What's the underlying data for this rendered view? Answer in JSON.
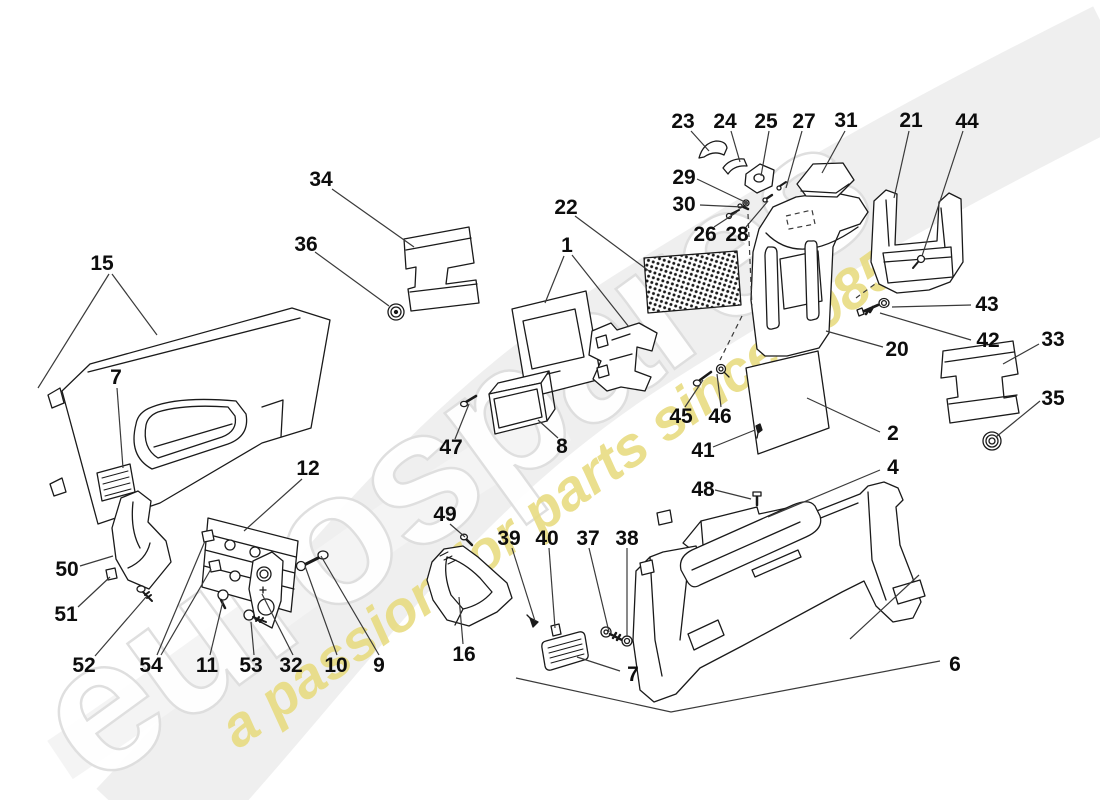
{
  "canvas": {
    "width": 1100,
    "height": 800
  },
  "watermark": {
    "brand_word": "eurospares",
    "tagline": "a passion for parts since 1985",
    "word_fill": "#ffffff",
    "word_outline": "#dedede",
    "tagline_color": "#e8dc82",
    "swoosh_color": "#efefef"
  },
  "colors": {
    "part_line": "#1a1a1a",
    "leader_line": "#3a3a3a",
    "mesh_dot": "#1a1a1a"
  },
  "diagram": {
    "labels": [
      {
        "n": "23",
        "x": 683,
        "y": 122
      },
      {
        "n": "24",
        "x": 725,
        "y": 122
      },
      {
        "n": "25",
        "x": 766,
        "y": 122
      },
      {
        "n": "27",
        "x": 804,
        "y": 122
      },
      {
        "n": "31",
        "x": 846,
        "y": 121
      },
      {
        "n": "21",
        "x": 911,
        "y": 121
      },
      {
        "n": "44",
        "x": 967,
        "y": 122
      },
      {
        "n": "29",
        "x": 684,
        "y": 178
      },
      {
        "n": "30",
        "x": 684,
        "y": 205
      },
      {
        "n": "26",
        "x": 705,
        "y": 235
      },
      {
        "n": "28",
        "x": 737,
        "y": 235
      },
      {
        "n": "22",
        "x": 566,
        "y": 208
      },
      {
        "n": "1",
        "x": 567,
        "y": 246
      },
      {
        "n": "34",
        "x": 321,
        "y": 180
      },
      {
        "n": "36",
        "x": 306,
        "y": 245
      },
      {
        "n": "15",
        "x": 102,
        "y": 264
      },
      {
        "n": "7",
        "x": 116,
        "y": 378
      },
      {
        "n": "43",
        "x": 987,
        "y": 305
      },
      {
        "n": "42",
        "x": 988,
        "y": 341
      },
      {
        "n": "33",
        "x": 1053,
        "y": 340
      },
      {
        "n": "35",
        "x": 1053,
        "y": 399
      },
      {
        "n": "20",
        "x": 897,
        "y": 350
      },
      {
        "n": "45",
        "x": 681,
        "y": 417
      },
      {
        "n": "46",
        "x": 720,
        "y": 417
      },
      {
        "n": "41",
        "x": 703,
        "y": 451
      },
      {
        "n": "2",
        "x": 893,
        "y": 434
      },
      {
        "n": "4",
        "x": 893,
        "y": 468
      },
      {
        "n": "48",
        "x": 703,
        "y": 490
      },
      {
        "n": "47",
        "x": 451,
        "y": 448
      },
      {
        "n": "8",
        "x": 562,
        "y": 447
      },
      {
        "n": "12",
        "x": 308,
        "y": 469
      },
      {
        "n": "49",
        "x": 445,
        "y": 515
      },
      {
        "n": "39",
        "x": 509,
        "y": 539
      },
      {
        "n": "40",
        "x": 547,
        "y": 539
      },
      {
        "n": "37",
        "x": 588,
        "y": 539
      },
      {
        "n": "38",
        "x": 627,
        "y": 539
      },
      {
        "n": "16",
        "x": 464,
        "y": 655
      },
      {
        "n": "7",
        "x": 633,
        "y": 675
      },
      {
        "n": "50",
        "x": 67,
        "y": 570
      },
      {
        "n": "51",
        "x": 66,
        "y": 615
      },
      {
        "n": "52",
        "x": 84,
        "y": 666
      },
      {
        "n": "54",
        "x": 151,
        "y": 666
      },
      {
        "n": "11",
        "x": 207,
        "y": 666
      },
      {
        "n": "53",
        "x": 251,
        "y": 666
      },
      {
        "n": "32",
        "x": 291,
        "y": 666
      },
      {
        "n": "10",
        "x": 336,
        "y": 666
      },
      {
        "n": "9",
        "x": 379,
        "y": 666
      },
      {
        "n": "6",
        "x": 955,
        "y": 665
      }
    ],
    "leaders": [
      {
        "points": [
          [
            691,
            131
          ],
          [
            709,
            151
          ]
        ]
      },
      {
        "points": [
          [
            731,
            131
          ],
          [
            740,
            162
          ]
        ]
      },
      {
        "points": [
          [
            769,
            131
          ],
          [
            761,
            176
          ]
        ]
      },
      {
        "points": [
          [
            802,
            131
          ],
          [
            786,
            188
          ]
        ]
      },
      {
        "points": [
          [
            845,
            131
          ],
          [
            822,
            173
          ]
        ]
      },
      {
        "points": [
          [
            909,
            131
          ],
          [
            894,
            198
          ]
        ]
      },
      {
        "points": [
          [
            963,
            131
          ],
          [
            922,
            256
          ]
        ]
      },
      {
        "points": [
          [
            697,
            179
          ],
          [
            745,
            202
          ]
        ]
      },
      {
        "points": [
          [
            700,
            205
          ],
          [
            743,
            207
          ]
        ]
      },
      {
        "points": [
          [
            714,
            227
          ],
          [
            737,
            212
          ]
        ]
      },
      {
        "points": [
          [
            746,
            227
          ],
          [
            768,
            201
          ]
        ]
      },
      {
        "points": [
          [
            575,
            216
          ],
          [
            649,
            271
          ]
        ]
      },
      {
        "points": [
          [
            564,
            256
          ],
          [
            545,
            303
          ]
        ]
      },
      {
        "points": [
          [
            572,
            255
          ],
          [
            629,
            327
          ]
        ]
      },
      {
        "points": [
          [
            332,
            189
          ],
          [
            414,
            247
          ]
        ]
      },
      {
        "points": [
          [
            315,
            252
          ],
          [
            389,
            306
          ]
        ]
      },
      {
        "points": [
          [
            109,
            274
          ],
          [
            38,
            388
          ]
        ]
      },
      {
        "points": [
          [
            112,
            274
          ],
          [
            157,
            335
          ]
        ]
      },
      {
        "points": [
          [
            117,
            388
          ],
          [
            123,
            468
          ]
        ]
      },
      {
        "points": [
          [
            971,
            305
          ],
          [
            892,
            307
          ]
        ]
      },
      {
        "points": [
          [
            971,
            340
          ],
          [
            880,
            313
          ]
        ]
      },
      {
        "points": [
          [
            1039,
            344
          ],
          [
            1003,
            364
          ]
        ]
      },
      {
        "points": [
          [
            1040,
            401
          ],
          [
            996,
            437
          ]
        ]
      },
      {
        "points": [
          [
            883,
            347
          ],
          [
            826,
            331
          ]
        ]
      },
      {
        "points": [
          [
            685,
            407
          ],
          [
            703,
            380
          ]
        ]
      },
      {
        "points": [
          [
            721,
            407
          ],
          [
            717,
            374
          ]
        ]
      },
      {
        "points": [
          [
            713,
            447
          ],
          [
            755,
            430
          ]
        ]
      },
      {
        "points": [
          [
            880,
            432
          ],
          [
            807,
            398
          ]
        ]
      },
      {
        "points": [
          [
            880,
            470
          ],
          [
            768,
            517
          ]
        ]
      },
      {
        "points": [
          [
            715,
            490
          ],
          [
            751,
            499
          ]
        ]
      },
      {
        "points": [
          [
            455,
            439
          ],
          [
            469,
            404
          ]
        ]
      },
      {
        "points": [
          [
            558,
            438
          ],
          [
            538,
            420
          ]
        ]
      },
      {
        "points": [
          [
            302,
            479
          ],
          [
            244,
            531
          ]
        ]
      },
      {
        "points": [
          [
            450,
            524
          ],
          [
            465,
            537
          ]
        ]
      },
      {
        "points": [
          [
            512,
            548
          ],
          [
            535,
            621
          ]
        ]
      },
      {
        "points": [
          [
            549,
            548
          ],
          [
            555,
            628
          ]
        ]
      },
      {
        "points": [
          [
            589,
            548
          ],
          [
            609,
            632
          ]
        ]
      },
      {
        "points": [
          [
            627,
            548
          ],
          [
            627,
            637
          ]
        ]
      },
      {
        "points": [
          [
            463,
            644
          ],
          [
            459,
            597
          ]
        ]
      },
      {
        "points": [
          [
            620,
            671
          ],
          [
            577,
            657
          ]
        ]
      },
      {
        "points": [
          [
            80,
            566
          ],
          [
            113,
            556
          ]
        ]
      },
      {
        "points": [
          [
            78,
            607
          ],
          [
            110,
            577
          ]
        ]
      },
      {
        "points": [
          [
            95,
            656
          ],
          [
            146,
            597
          ]
        ]
      },
      {
        "points": [
          [
            157,
            655
          ],
          [
            205,
            541
          ]
        ]
      },
      {
        "points": [
          [
            161,
            655
          ],
          [
            211,
            569
          ]
        ]
      },
      {
        "points": [
          [
            210,
            655
          ],
          [
            223,
            601
          ]
        ]
      },
      {
        "points": [
          [
            254,
            655
          ],
          [
            251,
            622
          ]
        ]
      },
      {
        "points": [
          [
            293,
            655
          ],
          [
            262,
            594
          ]
        ]
      },
      {
        "points": [
          [
            337,
            655
          ],
          [
            305,
            566
          ]
        ]
      },
      {
        "points": [
          [
            379,
            655
          ],
          [
            321,
            556
          ]
        ]
      },
      {
        "points": [
          [
            940,
            661
          ],
          [
            671,
            712
          ],
          [
            516,
            678
          ]
        ]
      },
      {
        "points": [
          [
            850,
            639
          ],
          [
            919,
            575
          ]
        ]
      },
      {
        "points": [
          [
            748,
            214
          ],
          [
            752,
            308
          ]
        ],
        "dashed": true
      },
      {
        "points": [
          [
            742,
            316
          ],
          [
            720,
            360
          ]
        ],
        "dashed": true
      },
      {
        "points": [
          [
            856,
            298
          ],
          [
            875,
            284
          ]
        ],
        "dashed": true
      },
      {
        "points": [
          [
            786,
            216
          ],
          [
            812,
            210
          ],
          [
            815,
            224
          ],
          [
            789,
            229
          ],
          [
            786,
            216
          ]
        ],
        "dashed": true
      }
    ]
  }
}
